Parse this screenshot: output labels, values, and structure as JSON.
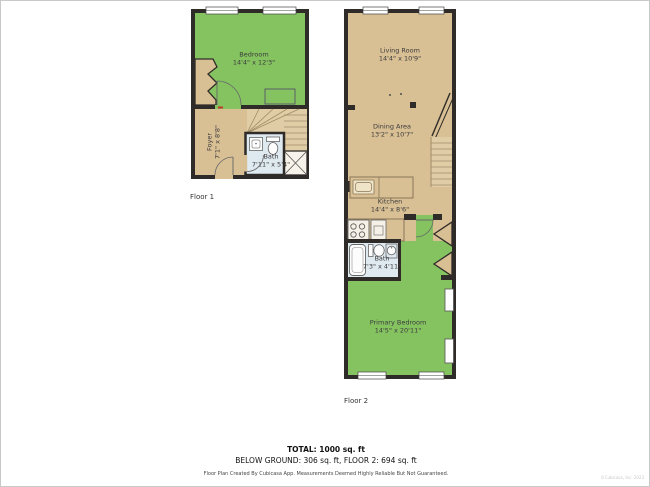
{
  "colors": {
    "green": "#85c361",
    "tan": "#d8bf94",
    "stair": "#e0cda6",
    "bath": "#dfe9f0",
    "wall": "#2f2b28"
  },
  "floor1": {
    "label": "Floor 1",
    "rooms": {
      "bedroom": {
        "name": "Bedroom",
        "dims": "14'4\" x 12'3\""
      },
      "foyer": {
        "name": "Foyer",
        "dims": "7'1\" x 8'8\""
      },
      "bath": {
        "name": "Bath",
        "dims": "7'11\" x 5'4\""
      }
    }
  },
  "floor2": {
    "label": "Floor 2",
    "rooms": {
      "living": {
        "name": "Living Room",
        "dims": "14'4\" x 10'9\""
      },
      "dining": {
        "name": "Dining Area",
        "dims": "13'2\" x 10'7\""
      },
      "kitchen": {
        "name": "Kitchen",
        "dims": "14'4\" x 8'6\""
      },
      "bath": {
        "name": "Bath",
        "dims": "7'3\" x 4'11\""
      },
      "primary": {
        "name": "Primary Bedroom",
        "dims": "14'5\" x 20'11\""
      }
    }
  },
  "footer": {
    "total": "TOTAL: 1000 sq. ft",
    "breakdown": "BELOW GROUND: 306 sq. ft, FLOOR 2: 694 sq. ft",
    "disclaimer": "Floor Plan Created By Cubicasa App. Measurements Deemed Highly Reliable But Not Guaranteed.",
    "watermark": "©Cubicasa, Inc. 2023"
  }
}
